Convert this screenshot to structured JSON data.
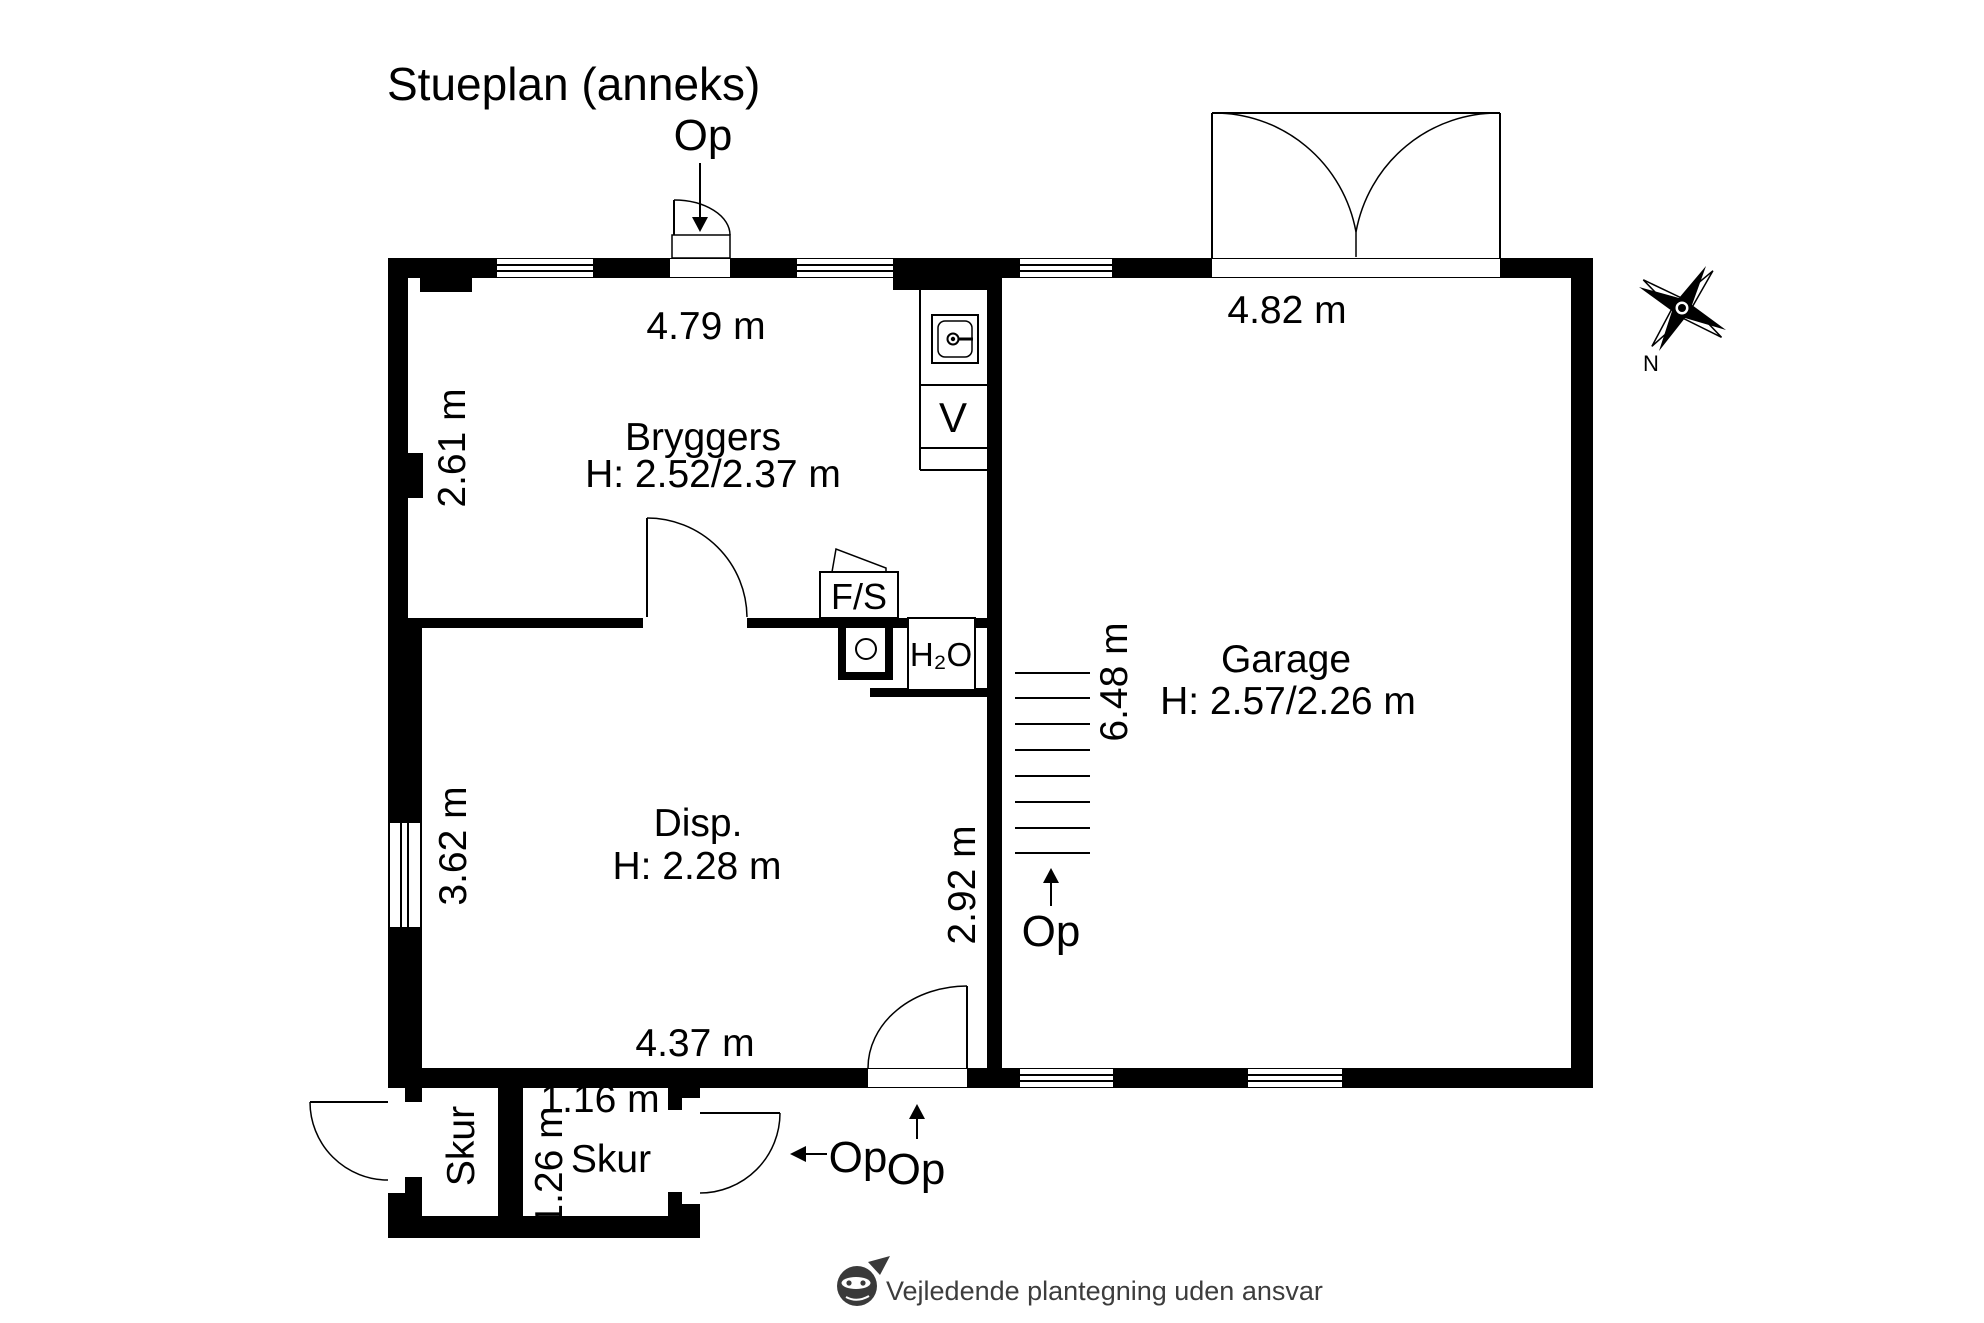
{
  "title": "Stueplan (anneks)",
  "floorplan": {
    "rooms": {
      "bryggers": {
        "name": "Bryggers",
        "ceiling": "H: 2.52/2.37 m",
        "width_label": "4.79 m",
        "depth_label": "2.61 m"
      },
      "disp": {
        "name": "Disp.",
        "ceiling": "H: 2.28 m",
        "width_label": "4.37 m",
        "depth_label": "3.62 m",
        "hall_depth_label": "2.92 m"
      },
      "garage": {
        "name": "Garage",
        "ceiling": "H: 2.57/2.26 m",
        "width_label": "4.82 m",
        "depth_label": "6.48 m"
      },
      "skur_left": {
        "name": "Skur"
      },
      "skur_right": {
        "name": "Skur",
        "width_label": "1.16 m",
        "depth_label": "1.26 m"
      }
    },
    "fixtures": {
      "washing_machine": "V",
      "freezer_cabinet": "F/S",
      "water": "H₂O"
    },
    "stair_direction_label": "Op",
    "door_direction_labels": {
      "bryggers_entry": "Op",
      "disp_entry": "Op",
      "skur_exit": "Op"
    },
    "compass_north": "N"
  },
  "footer": {
    "disclaimer": "Vejledende plantegning uden ansvar"
  },
  "colors": {
    "wall": "#000000",
    "paper": "#ffffff",
    "footer_text": "#3d3d3d",
    "logo": "#3a3a3a"
  }
}
